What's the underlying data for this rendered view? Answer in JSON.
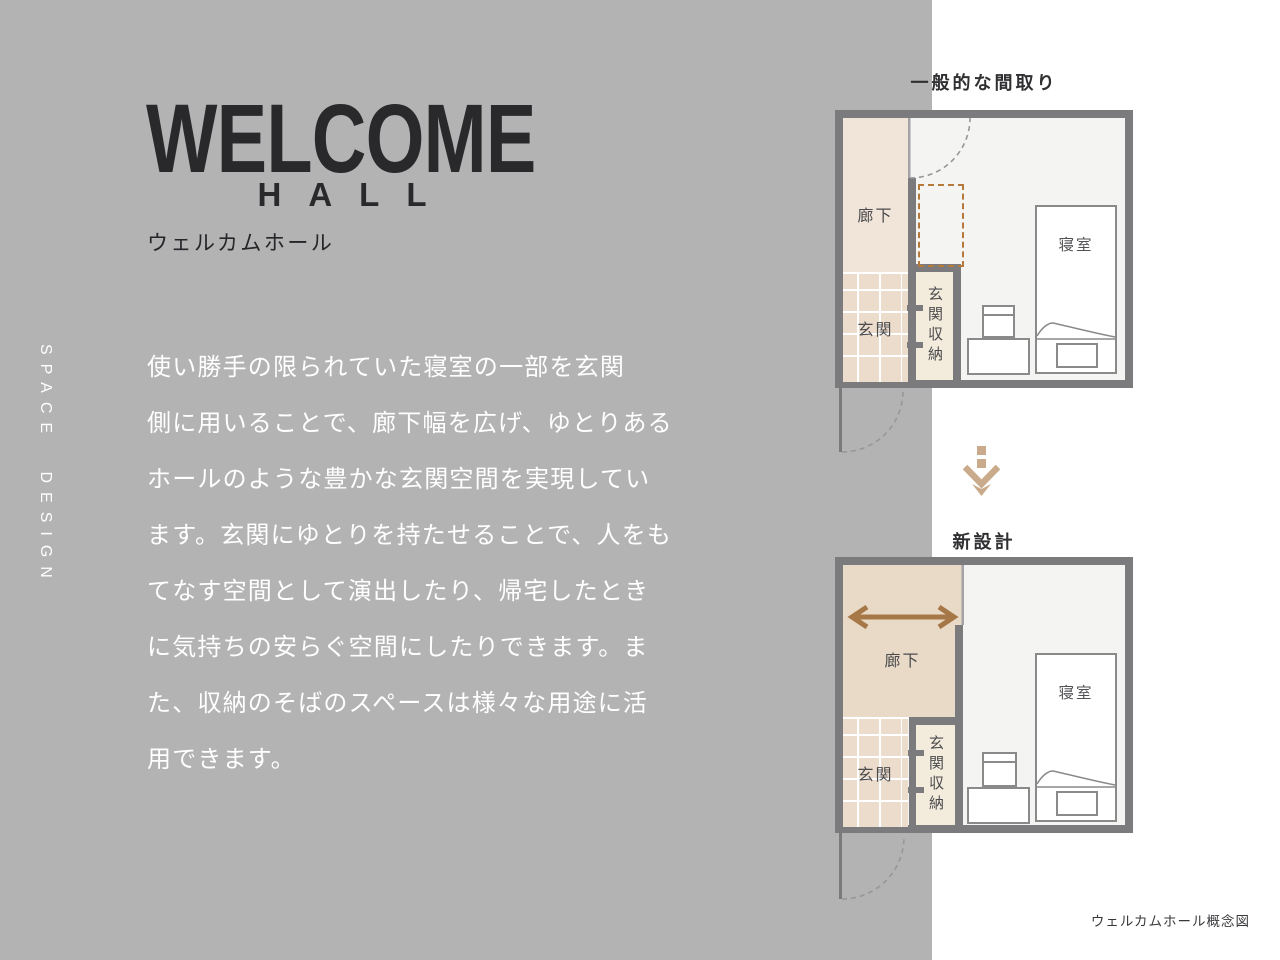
{
  "brand": {
    "vertical_label": "SPACE DESIGN"
  },
  "header": {
    "title": "WELCOME",
    "subtitle": "HALL",
    "title_ja": "ウェルカムホール"
  },
  "description": {
    "lines": [
      "使い勝手の限られていた寝室の一部を玄関",
      "側に用いることで、廊下幅を広げ、ゆとりある",
      "ホールのような豊かな玄関空間を実現してい",
      "ます。玄関にゆとりを持たせることで、人をも",
      "てなす空間として演出したり、帰宅したとき",
      "に気持ちの安らぐ空間にしたりできます。ま",
      "た、収納のそばのスペースは様々な用途に活",
      "用できます。"
    ]
  },
  "diagram": {
    "caption": "ウェルカムホール概念図",
    "typical_plan": {
      "heading": "一般的な間取り",
      "rooms": {
        "hallway": "廊下",
        "entrance": "玄関",
        "entrance_storage": "玄関収納",
        "bedroom": "寝室"
      }
    },
    "new_plan": {
      "heading": "新設計",
      "rooms": {
        "hallway": "廊下",
        "entrance": "玄関",
        "entrance_storage": "玄関収納",
        "bedroom": "寝室"
      }
    }
  },
  "colors": {
    "background_gray": "#b3b3b4",
    "panel_white": "#ffffff",
    "wall_gray": "#7b7b7e",
    "hallway_beige_typical": "#f0e5d8",
    "hallway_beige_new": "#e9d9c7",
    "tile_beige": "#ecdccb",
    "storage_beige": "#f3ebdc",
    "floor_light": "#f4f4f3",
    "accent_orange_dashed": "#b5793c",
    "arrow_brown": "#a67847",
    "down_arrow_tan": "#c9ab8b",
    "text_dark": "#2a2a2d",
    "text_white": "#ffffff"
  }
}
